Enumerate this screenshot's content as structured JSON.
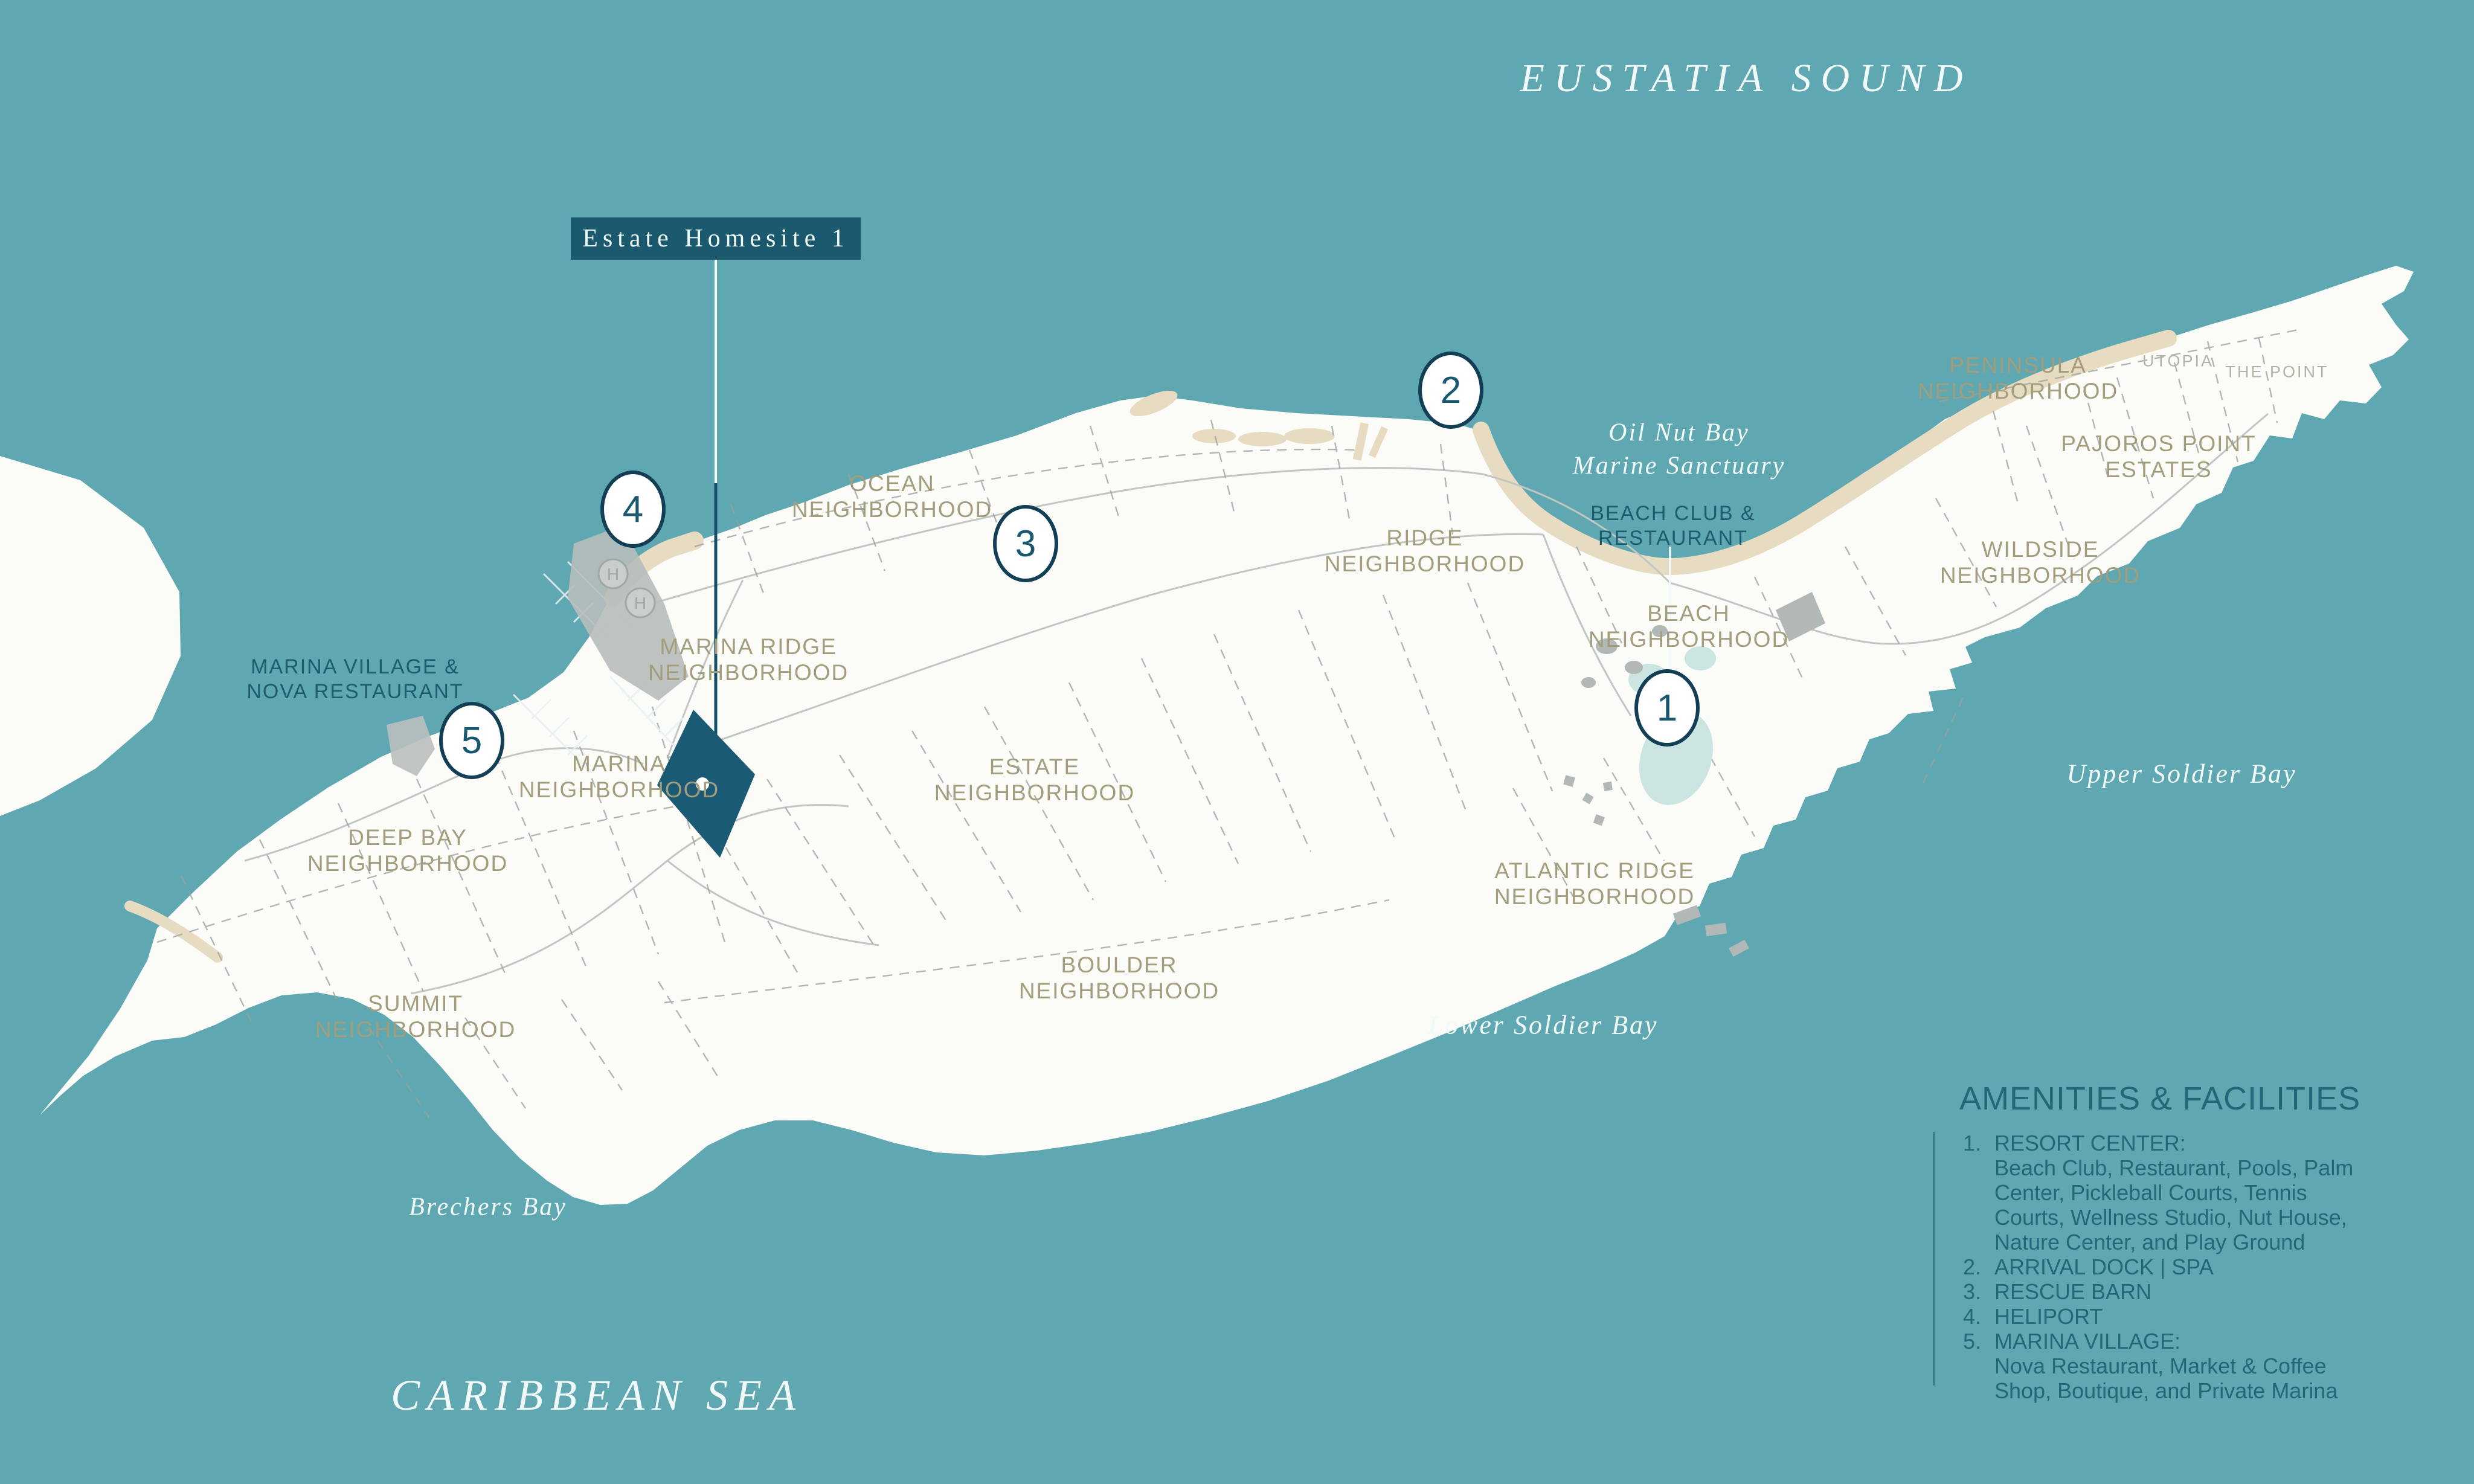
{
  "colors": {
    "sea": "#5FA8B2",
    "land": "#FBFBF8",
    "beach": "#E7DCC1",
    "accent_dark": "#1B5A6E",
    "marker_border": "#123F55",
    "text_dark_teal": "#1D5C6F",
    "text_olive": "#A29D7D",
    "text_gray": "#B5B2A8",
    "legend_text": "#216878",
    "building_gray": "#B2B8B6",
    "pond": "#CBE5E0",
    "line_gray": "#9AA09C",
    "white_text": "#F2FAF9"
  },
  "sea_labels": {
    "eustatia_sound": "EUSTATIA SOUND",
    "caribbean_sea": "CARIBBEAN SEA",
    "oil_nut_bay": "Oil Nut Bay\nMarine Sanctuary",
    "upper_soldier_bay": "Upper Soldier Bay",
    "lower_soldier_bay": "Lower Soldier Bay",
    "brechers_bay": "Brechers Bay"
  },
  "callout": {
    "estate_homesite": "Estate Homesite 1"
  },
  "neighborhoods": {
    "ocean": "OCEAN\nNEIGHBORHOOD",
    "marina_ridge": "MARINA RIDGE\nNEIGHBORHOOD",
    "marina": "MARINA\nNEIGHBORHOOD",
    "deep_bay": "DEEP BAY\nNEIGHBORHOOD",
    "summit": "SUMMIT\nNEIGHBORHOOD",
    "estate": "ESTATE\nNEIGHBORHOOD",
    "boulder": "BOULDER\nNEIGHBORHOOD",
    "ridge": "RIDGE\nNEIGHBORHOOD",
    "atlantic_ridge": "ATLANTIC RIDGE\nNEIGHBORHOOD",
    "beach": "BEACH\nNEIGHBORHOOD",
    "peninsula": "PENINSULA\nNEIGHBORHOOD",
    "pajoros": "PAJOROS POINT\nESTATES",
    "wildside": "WILDSIDE\nNEIGHBORHOOD"
  },
  "places": {
    "utopia": "UTOPIA",
    "the_point": "THE POINT"
  },
  "poi": {
    "beach_club": "BEACH CLUB &\nRESTAURANT",
    "marina_village": "MARINA VILLAGE &\nNOVA RESTAURANT"
  },
  "markers": {
    "m1": "1",
    "m2": "2",
    "m3": "3",
    "m4": "4",
    "m5": "5"
  },
  "heliport_letter": "H",
  "legend": {
    "title": "AMENITIES & FACILITIES",
    "items": [
      {
        "num": "1.",
        "text": "RESORT CENTER:\nBeach Club, Restaurant, Pools, Palm\nCenter, Pickleball Courts, Tennis\nCourts, Wellness Studio, Nut House,\nNature Center, and Play Ground"
      },
      {
        "num": "2.",
        "text": "ARRIVAL DOCK | SPA"
      },
      {
        "num": "3.",
        "text": "RESCUE BARN"
      },
      {
        "num": "4.",
        "text": "HELIPORT"
      },
      {
        "num": "5.",
        "text": "MARINA VILLAGE:\nNova Restaurant, Market & Coffee\nShop, Boutique, and Private Marina"
      }
    ]
  }
}
